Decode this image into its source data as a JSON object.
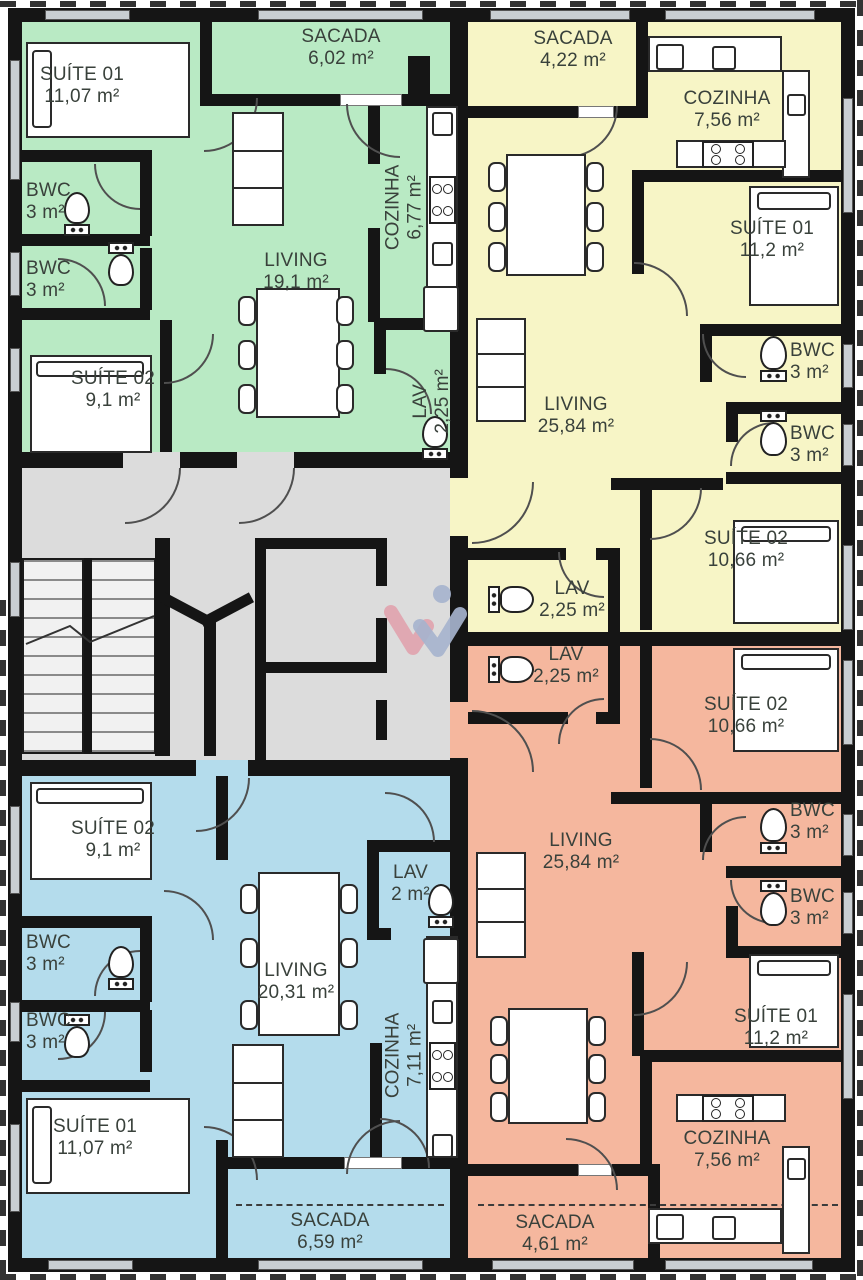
{
  "plan": {
    "watermark_letter": "w",
    "colors": {
      "wall": "#151515",
      "apartment_green": "#b9eac4",
      "apartment_yellow": "#f7f5c6",
      "apartment_blue": "#b4dcec",
      "apartment_orange": "#f5b79e",
      "core_gray": "#dcdcdc",
      "watermark_pink": "#dfa3ae",
      "watermark_blue": "#a6b3cd"
    },
    "apartments": {
      "green": {
        "rooms": [
          {
            "name": "SUÍTE 01",
            "area": "11,07 m²"
          },
          {
            "name": "BWC",
            "area": "3 m²"
          },
          {
            "name": "BWC",
            "area": "3 m²"
          },
          {
            "name": "SUÍTE 02",
            "area": "9,1 m²"
          },
          {
            "name": "LIVING",
            "area": "19,1 m²"
          },
          {
            "name": "SACADA",
            "area": "6,02 m²"
          },
          {
            "name": "COZINHA",
            "area": "6,77 m²"
          },
          {
            "name": "LAV",
            "area": "2,25 m²"
          }
        ]
      },
      "yellow": {
        "rooms": [
          {
            "name": "SACADA",
            "area": "4,22 m²"
          },
          {
            "name": "COZINHA",
            "area": "7,56 m²"
          },
          {
            "name": "SUÍTE 01",
            "area": "11,2 m²"
          },
          {
            "name": "BWC",
            "area": "3 m²"
          },
          {
            "name": "BWC",
            "area": "3 m²"
          },
          {
            "name": "LIVING",
            "area": "25,84 m²"
          },
          {
            "name": "SUÍTE 02",
            "area": "10,66 m²"
          },
          {
            "name": "LAV",
            "area": "2,25 m²"
          }
        ]
      },
      "blue": {
        "rooms": [
          {
            "name": "SUÍTE 02",
            "area": "9,1 m²"
          },
          {
            "name": "BWC",
            "area": "3 m²"
          },
          {
            "name": "BWC",
            "area": "3 m²"
          },
          {
            "name": "SUÍTE 01",
            "area": "11,07 m²"
          },
          {
            "name": "LIVING",
            "area": "20,31 m²"
          },
          {
            "name": "LAV",
            "area": "2 m²"
          },
          {
            "name": "COZINHA",
            "area": "7,11 m²"
          },
          {
            "name": "SACADA",
            "area": "6,59 m²"
          }
        ]
      },
      "orange": {
        "rooms": [
          {
            "name": "LAV",
            "area": "2,25 m²"
          },
          {
            "name": "SUÍTE 02",
            "area": "10,66 m²"
          },
          {
            "name": "BWC",
            "area": "3 m²"
          },
          {
            "name": "BWC",
            "area": "3 m²"
          },
          {
            "name": "LIVING",
            "area": "25,84 m²"
          },
          {
            "name": "SUÍTE 01",
            "area": "11,2 m²"
          },
          {
            "name": "COZINHA",
            "area": "7,56 m²"
          },
          {
            "name": "SACADA",
            "area": "4,61 m²"
          }
        ]
      }
    }
  }
}
